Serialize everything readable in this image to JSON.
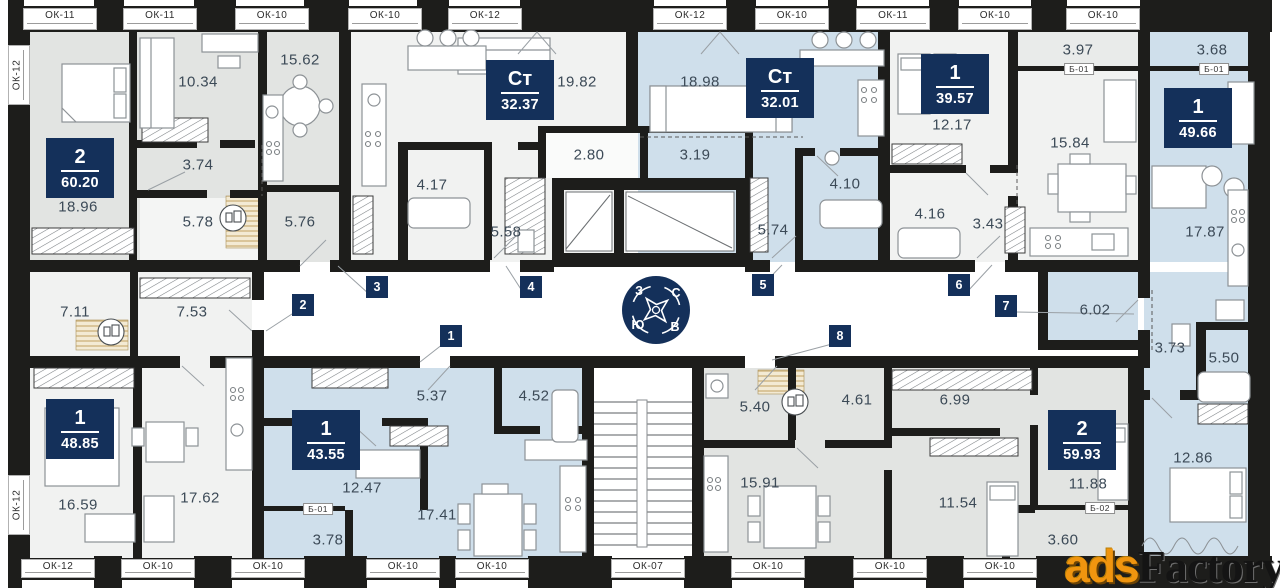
{
  "colors": {
    "wall": "#1d1d1b",
    "accent_navy": "#14305a",
    "room_gray": "#e2e4e2",
    "room_light": "#f1f2f1",
    "room_blue": "#cfdfeb",
    "label_text": "#3c4a57"
  },
  "compass": {
    "n": "С",
    "e": "В",
    "s": "Ю",
    "w": "З"
  },
  "watermark": {
    "accent": "ads",
    "rest": "Factory"
  },
  "windows": {
    "top": [
      {
        "label": "ОК-11",
        "x": 60
      },
      {
        "label": "ОК-11",
        "x": 160
      },
      {
        "label": "ОК-10",
        "x": 272
      },
      {
        "label": "ОК-10",
        "x": 385
      },
      {
        "label": "ОК-12",
        "x": 485
      },
      {
        "label": "ОК-12",
        "x": 690
      },
      {
        "label": "ОК-10",
        "x": 792
      },
      {
        "label": "ОК-11",
        "x": 893
      },
      {
        "label": "ОК-10",
        "x": 995
      },
      {
        "label": "ОК-10",
        "x": 1103
      }
    ],
    "bottom": [
      {
        "label": "ОК-12",
        "x": 58
      },
      {
        "label": "ОК-10",
        "x": 158
      },
      {
        "label": "ОК-10",
        "x": 268
      },
      {
        "label": "ОК-10",
        "x": 403
      },
      {
        "label": "ОК-10",
        "x": 492
      },
      {
        "label": "ОК-07",
        "x": 648
      },
      {
        "label": "ОК-10",
        "x": 768
      },
      {
        "label": "ОК-10",
        "x": 890
      },
      {
        "label": "ОК-10",
        "x": 1000
      }
    ],
    "left": [
      {
        "label": "ОК-12",
        "y": 75
      },
      {
        "label": "ОК-12",
        "y": 505
      }
    ]
  },
  "apartments": [
    {
      "number": "2",
      "area": "60.20",
      "x": 80,
      "y": 168
    },
    {
      "number": "Ст",
      "area": "32.37",
      "x": 520,
      "y": 90
    },
    {
      "number": "Ст",
      "area": "32.01",
      "x": 780,
      "y": 88
    },
    {
      "number": "1",
      "area": "39.57",
      "x": 955,
      "y": 84
    },
    {
      "number": "1",
      "area": "49.66",
      "x": 1198,
      "y": 118
    },
    {
      "number": "1",
      "area": "48.85",
      "x": 80,
      "y": 429
    },
    {
      "number": "1",
      "area": "43.55",
      "x": 326,
      "y": 440
    },
    {
      "number": "2",
      "area": "59.93",
      "x": 1082,
      "y": 440
    }
  ],
  "rooms": [
    {
      "area": "18.96",
      "x": 78,
      "y": 207
    },
    {
      "area": "10.34",
      "x": 198,
      "y": 82
    },
    {
      "area": "3.74",
      "x": 198,
      "y": 165
    },
    {
      "area": "5.78",
      "x": 198,
      "y": 222
    },
    {
      "area": "15.62",
      "x": 300,
      "y": 60
    },
    {
      "area": "5.76",
      "x": 300,
      "y": 222
    },
    {
      "area": "19.82",
      "x": 577,
      "y": 82
    },
    {
      "area": "2.80",
      "x": 589,
      "y": 155
    },
    {
      "area": "4.17",
      "x": 432,
      "y": 185
    },
    {
      "area": "5.58",
      "x": 506,
      "y": 232
    },
    {
      "area": "18.98",
      "x": 700,
      "y": 82
    },
    {
      "area": "3.19",
      "x": 695,
      "y": 155
    },
    {
      "area": "5.74",
      "x": 773,
      "y": 230
    },
    {
      "area": "4.10",
      "x": 845,
      "y": 184
    },
    {
      "area": "12.17",
      "x": 952,
      "y": 125
    },
    {
      "area": "4.16",
      "x": 930,
      "y": 214
    },
    {
      "area": "3.43",
      "x": 988,
      "y": 224
    },
    {
      "area": "3.97",
      "x": 1078,
      "y": 50
    },
    {
      "area": "15.84",
      "x": 1070,
      "y": 143
    },
    {
      "area": "3.68",
      "x": 1212,
      "y": 50
    },
    {
      "area": "17.87",
      "x": 1205,
      "y": 232
    },
    {
      "area": "6.02",
      "x": 1095,
      "y": 310
    },
    {
      "area": "3.73",
      "x": 1170,
      "y": 348
    },
    {
      "area": "5.50",
      "x": 1224,
      "y": 358
    },
    {
      "area": "12.86",
      "x": 1193,
      "y": 458
    },
    {
      "area": "7.11",
      "x": 75,
      "y": 312
    },
    {
      "area": "7.53",
      "x": 192,
      "y": 312
    },
    {
      "area": "16.59",
      "x": 78,
      "y": 505
    },
    {
      "area": "17.62",
      "x": 200,
      "y": 498
    },
    {
      "area": "5.37",
      "x": 432,
      "y": 396
    },
    {
      "area": "4.52",
      "x": 534,
      "y": 396
    },
    {
      "area": "12.47",
      "x": 362,
      "y": 488
    },
    {
      "area": "17.41",
      "x": 437,
      "y": 515
    },
    {
      "area": "3.78",
      "x": 328,
      "y": 540
    },
    {
      "area": "5.40",
      "x": 755,
      "y": 407
    },
    {
      "area": "4.61",
      "x": 857,
      "y": 400
    },
    {
      "area": "15.91",
      "x": 760,
      "y": 483
    },
    {
      "area": "6.99",
      "x": 955,
      "y": 400
    },
    {
      "area": "11.54",
      "x": 958,
      "y": 503
    },
    {
      "area": "11.88",
      "x": 1088,
      "y": 484
    },
    {
      "area": "3.60",
      "x": 1063,
      "y": 540
    }
  ],
  "markers": [
    {
      "label": "1",
      "x": 451,
      "y": 336
    },
    {
      "label": "2",
      "x": 303,
      "y": 305
    },
    {
      "label": "3",
      "x": 377,
      "y": 287
    },
    {
      "label": "4",
      "x": 531,
      "y": 287
    },
    {
      "label": "5",
      "x": 763,
      "y": 285
    },
    {
      "label": "6",
      "x": 959,
      "y": 285
    },
    {
      "label": "7",
      "x": 1006,
      "y": 306
    },
    {
      "label": "8",
      "x": 840,
      "y": 336
    }
  ],
  "balconies": [
    {
      "label": "Б-01",
      "x": 1079,
      "y": 69
    },
    {
      "label": "Б-01",
      "x": 1214,
      "y": 69
    },
    {
      "label": "Б-01",
      "x": 318,
      "y": 509
    },
    {
      "label": "Б-02",
      "x": 1100,
      "y": 508
    }
  ]
}
